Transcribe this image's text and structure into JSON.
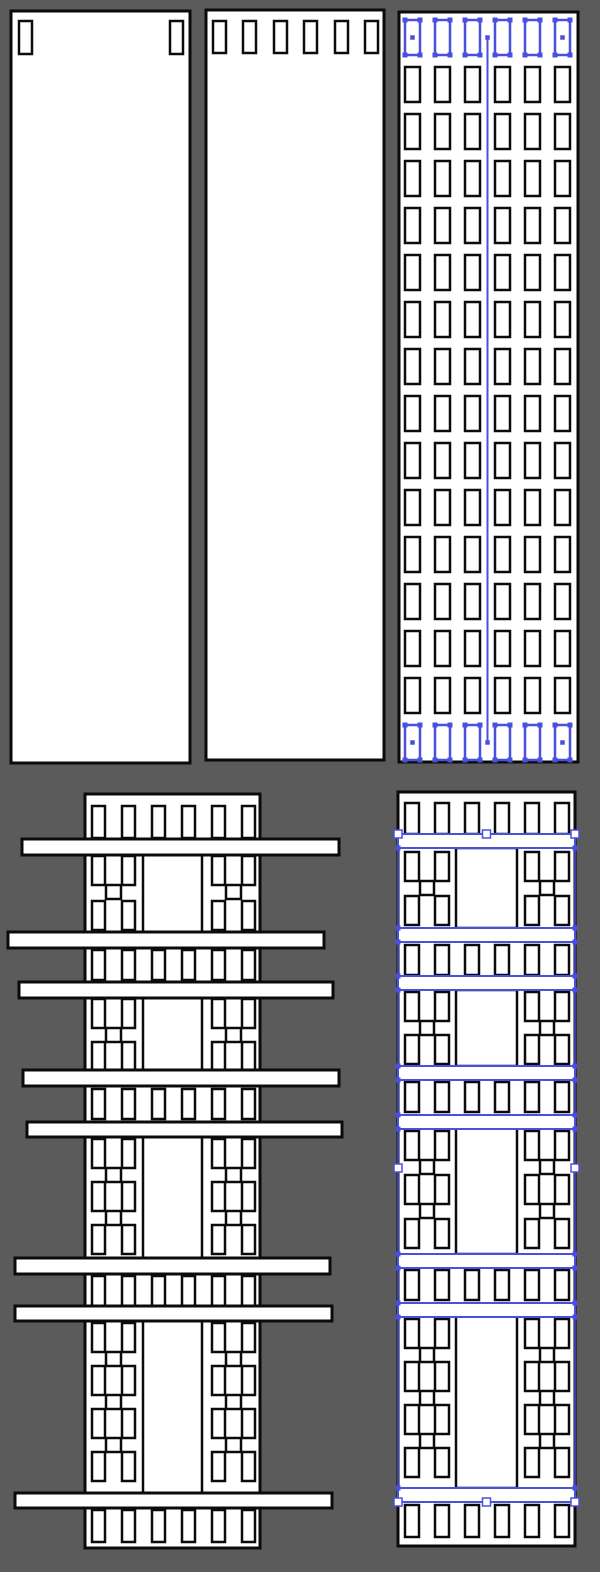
{
  "canvas": {
    "width": 600,
    "height": 1572,
    "background": "#5b5b5b"
  },
  "palette": {
    "k": "#0b0b0b",
    "b": "#4a50de",
    "w": "#ffffff",
    "bg": "#5b5b5b",
    "n": "none"
  },
  "selection": {
    "color": "#4a50de",
    "anchor_size": 5,
    "handle_size": 8
  },
  "objects": [
    {
      "name": "canvas-background",
      "interactable": true,
      "shapes": [
        {
          "t": "r",
          "x": 0,
          "y": 0,
          "w": 600,
          "h": 1572,
          "f": "bg",
          "s": "n",
          "sw": 0
        }
      ]
    },
    {
      "name": "part-blank-panel",
      "interactable": true,
      "shapes": [
        {
          "t": "r",
          "x": 11,
          "y": 11,
          "w": 179,
          "h": 752,
          "sw": 3
        },
        {
          "t": "g",
          "cols": [
            19,
            170
          ],
          "rows": [
            21
          ],
          "w": 13,
          "h": 33,
          "sw": 2.5
        }
      ]
    },
    {
      "name": "part-top-slotted-panel",
      "interactable": true,
      "shapes": [
        {
          "t": "r",
          "x": 206,
          "y": 10,
          "w": 178,
          "h": 750,
          "sw": 3
        },
        {
          "t": "g",
          "cols": [
            213,
            243,
            274,
            304,
            335,
            365
          ],
          "rows": [
            21
          ],
          "w": 13,
          "h": 32,
          "sw": 2.5
        }
      ]
    },
    {
      "name": "part-grid-panel",
      "interactable": true,
      "shapes": [
        {
          "t": "r",
          "x": 399,
          "y": 12,
          "w": 179,
          "h": 750,
          "sw": 3
        },
        {
          "t": "g",
          "cols": [
            405,
            435,
            465,
            495,
            525,
            555
          ],
          "rows": [
            67,
            114,
            161,
            208,
            255,
            302,
            349,
            396,
            443,
            490,
            537,
            584,
            631,
            678
          ],
          "w": 15,
          "h": 35,
          "sw": 2.5
        }
      ]
    },
    {
      "name": "grid-panel-selection",
      "interactable": true,
      "shapes": [
        {
          "t": "l",
          "x1": 487.5,
          "y1": 37.5,
          "x2": 487.5,
          "y2": 742.5,
          "s": "b",
          "sw": 2
        },
        {
          "t": "g",
          "cols": [
            405,
            435,
            465,
            495,
            525,
            555
          ],
          "rows": [
            20,
            725
          ],
          "w": 15,
          "h": 35,
          "s": "b",
          "sw": 2.5
        },
        {
          "t": "q",
          "xs": [
            405,
            420,
            435,
            450,
            465,
            480,
            495,
            510,
            525,
            540,
            555,
            570
          ],
          "ys": [
            20,
            55,
            725,
            760
          ],
          "sz": 5
        },
        {
          "t": "q",
          "pts": [
            [
              412.5,
              37.5
            ],
            [
              487.5,
              37.5
            ],
            [
              562.5,
              37.5
            ],
            [
              412.5,
              742.5
            ],
            [
              487.5,
              742.5
            ],
            [
              562.5,
              742.5
            ]
          ],
          "sz": 4.5
        }
      ]
    },
    {
      "name": "part-assembly-left",
      "interactable": true,
      "shapes": [
        {
          "t": "r",
          "x": 85,
          "y": 794,
          "w": 175,
          "h": 754,
          "sw": 3
        },
        {
          "t": "g",
          "cols": [
            92,
            122,
            152,
            182,
            212,
            242
          ],
          "rows": [
            806
          ],
          "w": 13,
          "h": 32,
          "sw": 2.5
        },
        {
          "t": "r",
          "x": 143,
          "y": 855,
          "w": 59,
          "h": 77,
          "sw": 2.5
        },
        {
          "t": "r",
          "x": 143,
          "y": 998,
          "w": 59,
          "h": 72,
          "sw": 2.5
        },
        {
          "t": "r",
          "x": 143,
          "y": 1137,
          "w": 59,
          "h": 121,
          "sw": 2.5
        },
        {
          "t": "r",
          "x": 143,
          "y": 1321,
          "w": 59,
          "h": 172,
          "sw": 2.5
        },
        {
          "t": "g",
          "cols": [
            92,
            122,
            212,
            242
          ],
          "rows": [
            856,
            901,
            999,
            1042,
            1139,
            1182,
            1225,
            1323,
            1366,
            1409,
            1452
          ],
          "w": 13,
          "h": 29,
          "sw": 2.5
        },
        {
          "t": "g",
          "cols": [
            106,
            226
          ],
          "rows": [
            885,
            1028,
            1168,
            1211,
            1352,
            1395,
            1438
          ],
          "w": 15,
          "h": 14,
          "sw": 2.5
        },
        {
          "t": "g",
          "cols": [
            92,
            122,
            152,
            182,
            212,
            242
          ],
          "rows": [
            950,
            1089,
            1276
          ],
          "w": 13,
          "h": 30,
          "sw": 2.5
        },
        {
          "t": "g",
          "cols": [
            92,
            122,
            152,
            182,
            212,
            242
          ],
          "rows": [
            1510
          ],
          "w": 13,
          "h": 32,
          "sw": 2.5
        },
        {
          "t": "r",
          "x": 22,
          "y": 839,
          "w": 317,
          "h": 16,
          "sw": 3
        },
        {
          "t": "r",
          "x": 8,
          "y": 932,
          "w": 316,
          "h": 16,
          "sw": 3
        },
        {
          "t": "r",
          "x": 19,
          "y": 982,
          "w": 314,
          "h": 16,
          "sw": 3
        },
        {
          "t": "r",
          "x": 23,
          "y": 1070,
          "w": 316,
          "h": 16,
          "sw": 3
        },
        {
          "t": "r",
          "x": 27,
          "y": 1122,
          "w": 315,
          "h": 15,
          "sw": 3
        },
        {
          "t": "r",
          "x": 15,
          "y": 1258,
          "w": 315,
          "h": 16,
          "sw": 3
        },
        {
          "t": "r",
          "x": 15,
          "y": 1306,
          "w": 317,
          "h": 15,
          "sw": 3
        },
        {
          "t": "r",
          "x": 15,
          "y": 1493,
          "w": 317,
          "h": 15,
          "sw": 3
        }
      ]
    },
    {
      "name": "part-assembly-right",
      "interactable": true,
      "shapes": [
        {
          "t": "r",
          "x": 398,
          "y": 792,
          "w": 177,
          "h": 754,
          "sw": 3
        },
        {
          "t": "g",
          "cols": [
            405,
            435,
            465,
            495,
            525,
            555
          ],
          "rows": [
            803
          ],
          "w": 14,
          "h": 31,
          "sw": 2.5
        },
        {
          "t": "r",
          "x": 456,
          "y": 848,
          "w": 61,
          "h": 80,
          "sw": 2.5
        },
        {
          "t": "r",
          "x": 456,
          "y": 990,
          "w": 61,
          "h": 76,
          "sw": 2.5
        },
        {
          "t": "r",
          "x": 456,
          "y": 1128,
          "w": 61,
          "h": 126,
          "sw": 2.5
        },
        {
          "t": "r",
          "x": 456,
          "y": 1316,
          "w": 61,
          "h": 172,
          "sw": 2.5
        },
        {
          "t": "g",
          "cols": [
            405,
            435,
            525,
            555
          ],
          "rows": [
            852,
            896,
            992,
            1035,
            1131,
            1175,
            1219,
            1319,
            1362,
            1405,
            1448
          ],
          "w": 14,
          "h": 29,
          "sw": 2.5
        },
        {
          "t": "g",
          "cols": [
            420,
            540
          ],
          "rows": [
            881,
            1021,
            1160,
            1204,
            1348,
            1391,
            1434
          ],
          "w": 14,
          "h": 14,
          "sw": 2.5
        },
        {
          "t": "g",
          "cols": [
            405,
            435,
            465,
            495,
            525,
            555
          ],
          "rows": [
            945,
            1082,
            1270
          ],
          "w": 14,
          "h": 30,
          "sw": 2.5
        },
        {
          "t": "g",
          "cols": [
            405,
            435,
            465,
            495,
            525,
            555
          ],
          "rows": [
            1505
          ],
          "w": 14,
          "h": 32,
          "sw": 2.5
        },
        {
          "t": "g",
          "cols": [
            398
          ],
          "rows": [
            834,
            928,
            976,
            1066,
            1115,
            1254,
            1303,
            1488
          ],
          "w": 177,
          "h": 14,
          "s": "b",
          "sw": 2
        }
      ]
    },
    {
      "name": "selection-handles-right",
      "interactable": true,
      "shapes": [
        {
          "t": "l",
          "x1": 398,
          "y1": 834,
          "x2": 398,
          "y2": 1502,
          "s": "b",
          "sw": 1.5
        },
        {
          "t": "l",
          "x1": 575,
          "y1": 834,
          "x2": 575,
          "y2": 1502,
          "s": "b",
          "sw": 1.5
        },
        {
          "t": "q",
          "xs": [
            398,
            575
          ],
          "ys": [
            834,
            848,
            928,
            942,
            976,
            990,
            1066,
            1080,
            1115,
            1129,
            1254,
            1268,
            1303,
            1317,
            1488,
            1502
          ],
          "sz": 5
        },
        {
          "t": "q",
          "pts": [
            [
              398,
              834
            ],
            [
              486.5,
              834
            ],
            [
              575,
              834
            ],
            [
              398,
              1168
            ],
            [
              575,
              1168
            ],
            [
              398,
              1502
            ],
            [
              486.5,
              1502
            ],
            [
              575,
              1502
            ]
          ],
          "sz": 8,
          "f": "w",
          "s": "b",
          "sw": 1.5
        }
      ]
    }
  ]
}
